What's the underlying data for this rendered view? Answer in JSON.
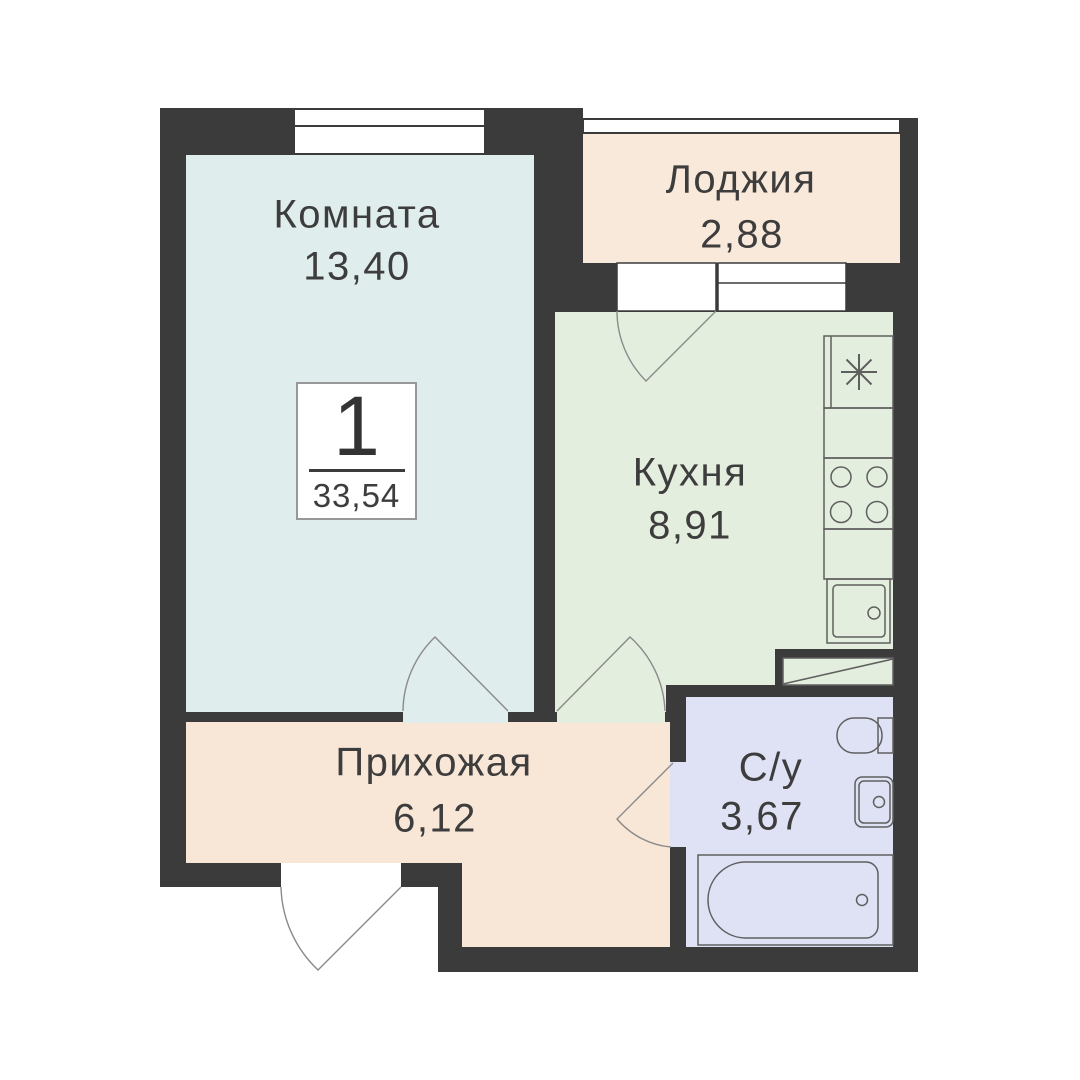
{
  "apartment": {
    "number": "1",
    "total_area": "33,54"
  },
  "rooms": [
    {
      "name": "Комната",
      "area": "13,40"
    },
    {
      "name": "Лоджия",
      "area": "2,88"
    },
    {
      "name": "Кухня",
      "area": "8,91"
    },
    {
      "name": "Прихожая",
      "area": "6,12"
    },
    {
      "name": "С/у",
      "area": "3,67"
    }
  ],
  "fixtures": [
    "fridge-icon",
    "stove-icon",
    "kitchen-sink-icon",
    "vent-shaft-icon",
    "toilet-icon",
    "bathroom-sink-icon",
    "bathtub-icon"
  ],
  "colors": {
    "wall": "#3b3b3b",
    "room": "#dfedec",
    "loggia": "#f9e9db",
    "kitchen": "#e4eede",
    "hallway": "#f8e6d7",
    "bathroom": "#dee2f4",
    "window_fill": "#ffffff",
    "outline": "#5f5f5f",
    "door_arc": "#8a8a8a",
    "text": "#3d3d3d"
  }
}
